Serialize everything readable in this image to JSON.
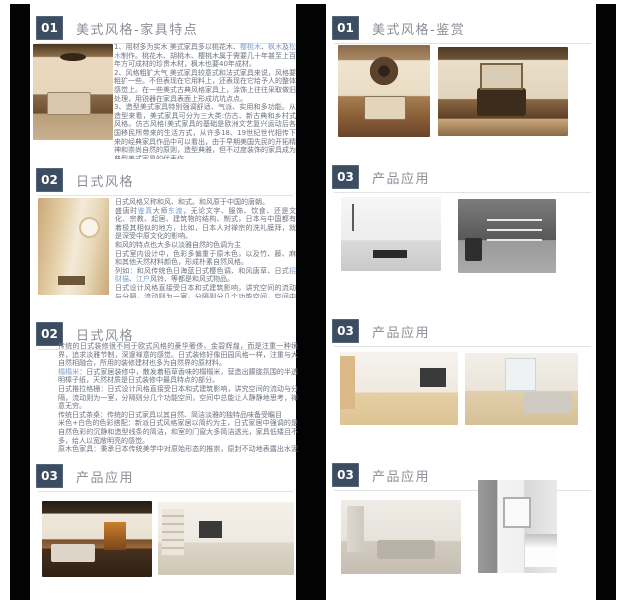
{
  "theme": {
    "badge_bg": "#3c4d62",
    "badge_text": "#ffffff",
    "title_color": "#8a8e96",
    "body_color": "#6f7380",
    "link_color": "#7d9fce",
    "rule_color": "#e3e3e6",
    "side_bar_color": "#030303",
    "page_bg": "#ffffff"
  },
  "left_panel": {
    "sections": [
      {
        "number": "01",
        "title": "美式风格-家具特点",
        "image": "american-classic-bedroom-photo",
        "paragraphs": [
          [
            {
              "t": "1、用材多为实木 美式家具多以桃花木、"
            },
            {
              "t": "樱桃木",
              "link": true
            },
            {
              "t": "、"
            },
            {
              "t": "枫木",
              "link": true
            },
            {
              "t": "及"
            },
            {
              "t": "松木",
              "link": true
            },
            {
              "t": "制作。桃花木、胡桃木、樱桃木属于需要几十年甚至上百年方可成材的珍贵木材，枫木也要40年成材。"
            }
          ],
          [
            {
              "t": "2、风格粗犷大气 美式家具较意式和法式家具来说，风格要粗犷一些。不但表现在它用料上，还表现在它给予人的整体感觉上。在一些美式古典风格家具上，涂饰上往往采取做旧处理，用锐器在家具表面上形成坑坑点点。"
            }
          ],
          [
            {
              "t": "3、造型美式家具特别强调舒适、气派、实用和多功能。从造型来看，美式家具可分为三大类:仿古、新古典和乡村式风格。仿古风格(美式家具的基础是欧洲文艺复兴运动后各国移民所带来的生活方式，从许多18、19世纪世代相传下来的经典家具作品中可以看出，由于早期美国先民的开拓精神和崇尚自然的原则，造型典雅，但不过度装饰的家具成为典型美式家具的代表作。"
            }
          ]
        ]
      },
      {
        "number": "02",
        "title": "日式风格",
        "image": "japanese-round-window-room-photo",
        "paragraphs": [
          [
            {
              "t": "日式风格又称和风、和式。和风原于中国的唐朝。"
            }
          ],
          [
            {
              "t": "盛唐时"
            },
            {
              "t": "鉴真",
              "link": true
            },
            {
              "t": "大师"
            },
            {
              "t": "东渡",
              "link": true
            },
            {
              "t": "，无论文字、服饰、饮食、还是文化、宗教、起居、建筑物的结构、制式，日本与中国都有着极其相似的地方，比如，日本人对禅宗的洗礼膜拜，就是深受中原文化的影响。"
            }
          ],
          [
            {
              "t": "和风的特点也大多以淡雅自然的色调为主"
            }
          ],
          [
            {
              "t": "日式室内设计中，色彩多偏重于原木色，以及竹、藤、麻和其他天然材料颜色，形成朴素自然风格。"
            }
          ],
          [
            {
              "t": "列如：和风传统色日海蓝日式樱色调、和风唐草、日式"
            },
            {
              "t": "招财猫",
              "link": true
            },
            {
              "t": "、"
            },
            {
              "t": "江户",
              "link": true
            },
            {
              "t": "风铃、等都是和风式物品。"
            }
          ],
          [
            {
              "t": "日式设计风格直接受日本和式建筑影响，讲究空间的流动与分隔，流动则为一室，分隔则分几个功能空间，空间中总能让人静静地思考。"
            }
          ],
          [
            {
              "t": "传统的"
            },
            {
              "t": "日式家居",
              "link": true
            },
            {
              "t": "将自然界的材质大量运用于居室的装修、装饰中，以节制、禅意为境界。"
            }
          ]
        ]
      },
      {
        "number": "02",
        "title": "日式风格",
        "paragraphs": [
          [
            {
              "t": "传统的日式装修很不同于欧式风格的豪华奢侈、金碧辉煌，而是注重一种境界，追求淡雅节制，深邃禅意的感觉。日式装修好像田园风格一样，注重与大自然相融合，所用的装修建材也多为自然界的原材料。"
            }
          ],
          [
            {
              "t": "榻榻米",
              "link": true
            },
            {
              "t": "：日式家居装修中，散发着稻草香味的榻榻米，营造出朦胧氛围的半透明樟子纸，天然材质是日式装修中最具特点的部分。"
            }
          ],
          [
            {
              "t": "日式推拉格栅：日式设计风格直接受日本和式建筑影响，讲究空间的流动与分隔，流动则为一室，分隔则分几个功能空间，空间中总能让人静静地思考，禅意无穷。"
            }
          ],
          [
            {
              "t": "传统日式茶桌：传统的日式家具以其自然、简洁淡雅的独特品味备受瞩目"
            }
          ],
          [
            {
              "t": "米色+白色的色彩搭配：新派日式风格家居以简约为主，日式家居中强调的是自然色彩的沉静和造型线条的简洁，和室的门窗大多简洁透光，家具低矮且不多，给人以宽敞明亮的感觉。"
            }
          ],
          [
            {
              "t": "原木色家具：秉承日本传统美学中对原始形态的推崇，原封不动地表露出水泥表面、木材质地、金属板格或饰面，着意显示素材的本来面目，加以精密的打磨，表现出素材的独特肌理——这种过滤的空间效果具有冷静的、光滑的视觉表面性，即牵动人们的情愫，使城市中人潜在的怀旧、怀乡、回归自然的情绪得到补偿。"
            }
          ]
        ]
      },
      {
        "number": "03",
        "title": "产品应用",
        "images": [
          "american-dark-beam-living-room-photo",
          "american-white-classic-living-room-photo"
        ]
      }
    ]
  },
  "right_panel": {
    "sections": [
      {
        "number": "01",
        "title": "美式风格-鉴赏",
        "images": [
          "american-fan-ceiling-living-room-photo",
          "american-beam-dining-room-photo"
        ]
      },
      {
        "number": "03",
        "title": "产品应用",
        "images": [
          "monochrome-minimal-living-room-photo",
          "monochrome-shelving-wall-photo"
        ]
      },
      {
        "number": "03",
        "title": "产品应用",
        "images": [
          "japanese-light-wood-living-room-photo",
          "japanese-light-wood-lounge-photo"
        ]
      },
      {
        "number": "03",
        "title": "产品应用",
        "images": [
          "modern-gray-living-room-photo",
          "modern-white-kitchen-photo"
        ]
      }
    ]
  }
}
